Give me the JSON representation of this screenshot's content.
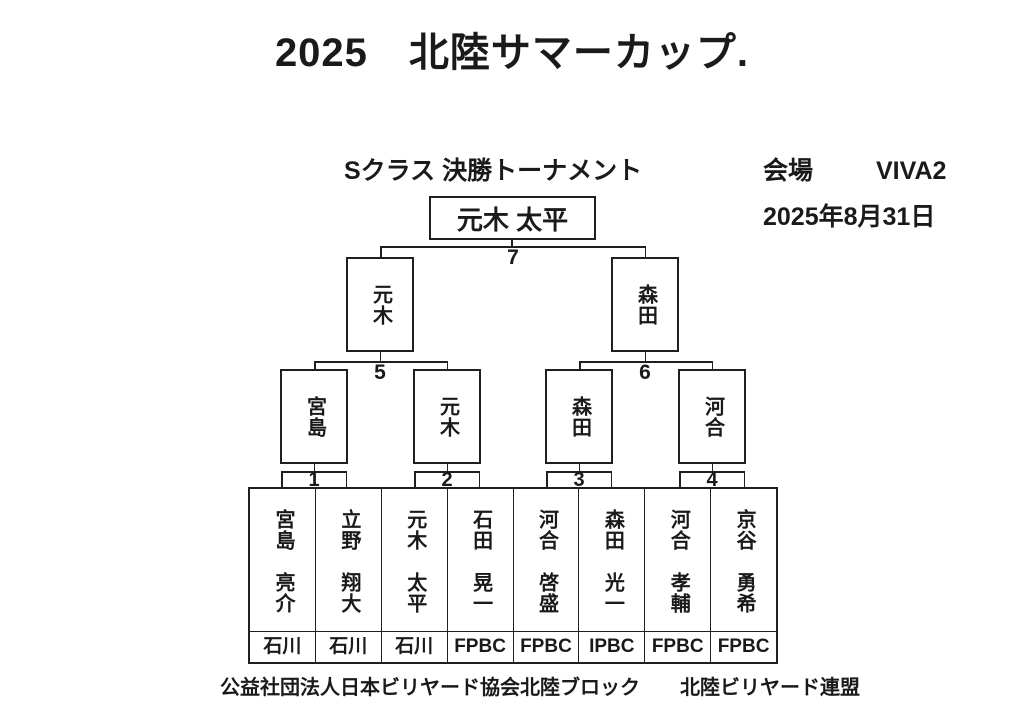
{
  "title": "2025　北陸サマーカップ.",
  "header": {
    "class_label": "Sクラス 決勝トーナメント",
    "venue_label": "会場",
    "venue_value": "VIVA2",
    "date": "2025年8月31日"
  },
  "bracket": {
    "champion": "元木 太平",
    "final_match_no": "7",
    "semifinals": [
      {
        "name": "元木",
        "match_no": "5"
      },
      {
        "name": "森田",
        "match_no": "6"
      }
    ],
    "quarterfinals": [
      {
        "name": "宮島",
        "match_no": "1"
      },
      {
        "name": "元木",
        "match_no": "2"
      },
      {
        "name": "森田",
        "match_no": "3"
      },
      {
        "name": "河合",
        "match_no": "4"
      }
    ]
  },
  "players": [
    {
      "name": "宮島　亮介",
      "club": "石川"
    },
    {
      "name": "立野　翔大",
      "club": "石川"
    },
    {
      "name": "元木　太平",
      "club": "石川"
    },
    {
      "name": "石田　晃一",
      "club": "FPBC"
    },
    {
      "name": "河合　啓盛",
      "club": "FPBC"
    },
    {
      "name": "森田　光一",
      "club": "IPBC"
    },
    {
      "name": "河合　孝輔",
      "club": "FPBC"
    },
    {
      "name": "京谷　勇希",
      "club": "FPBC"
    }
  ],
  "footer": {
    "org1": "公益社団法人日本ビリヤード協会北陸ブロック",
    "org2": "北陸ビリヤード連盟"
  }
}
